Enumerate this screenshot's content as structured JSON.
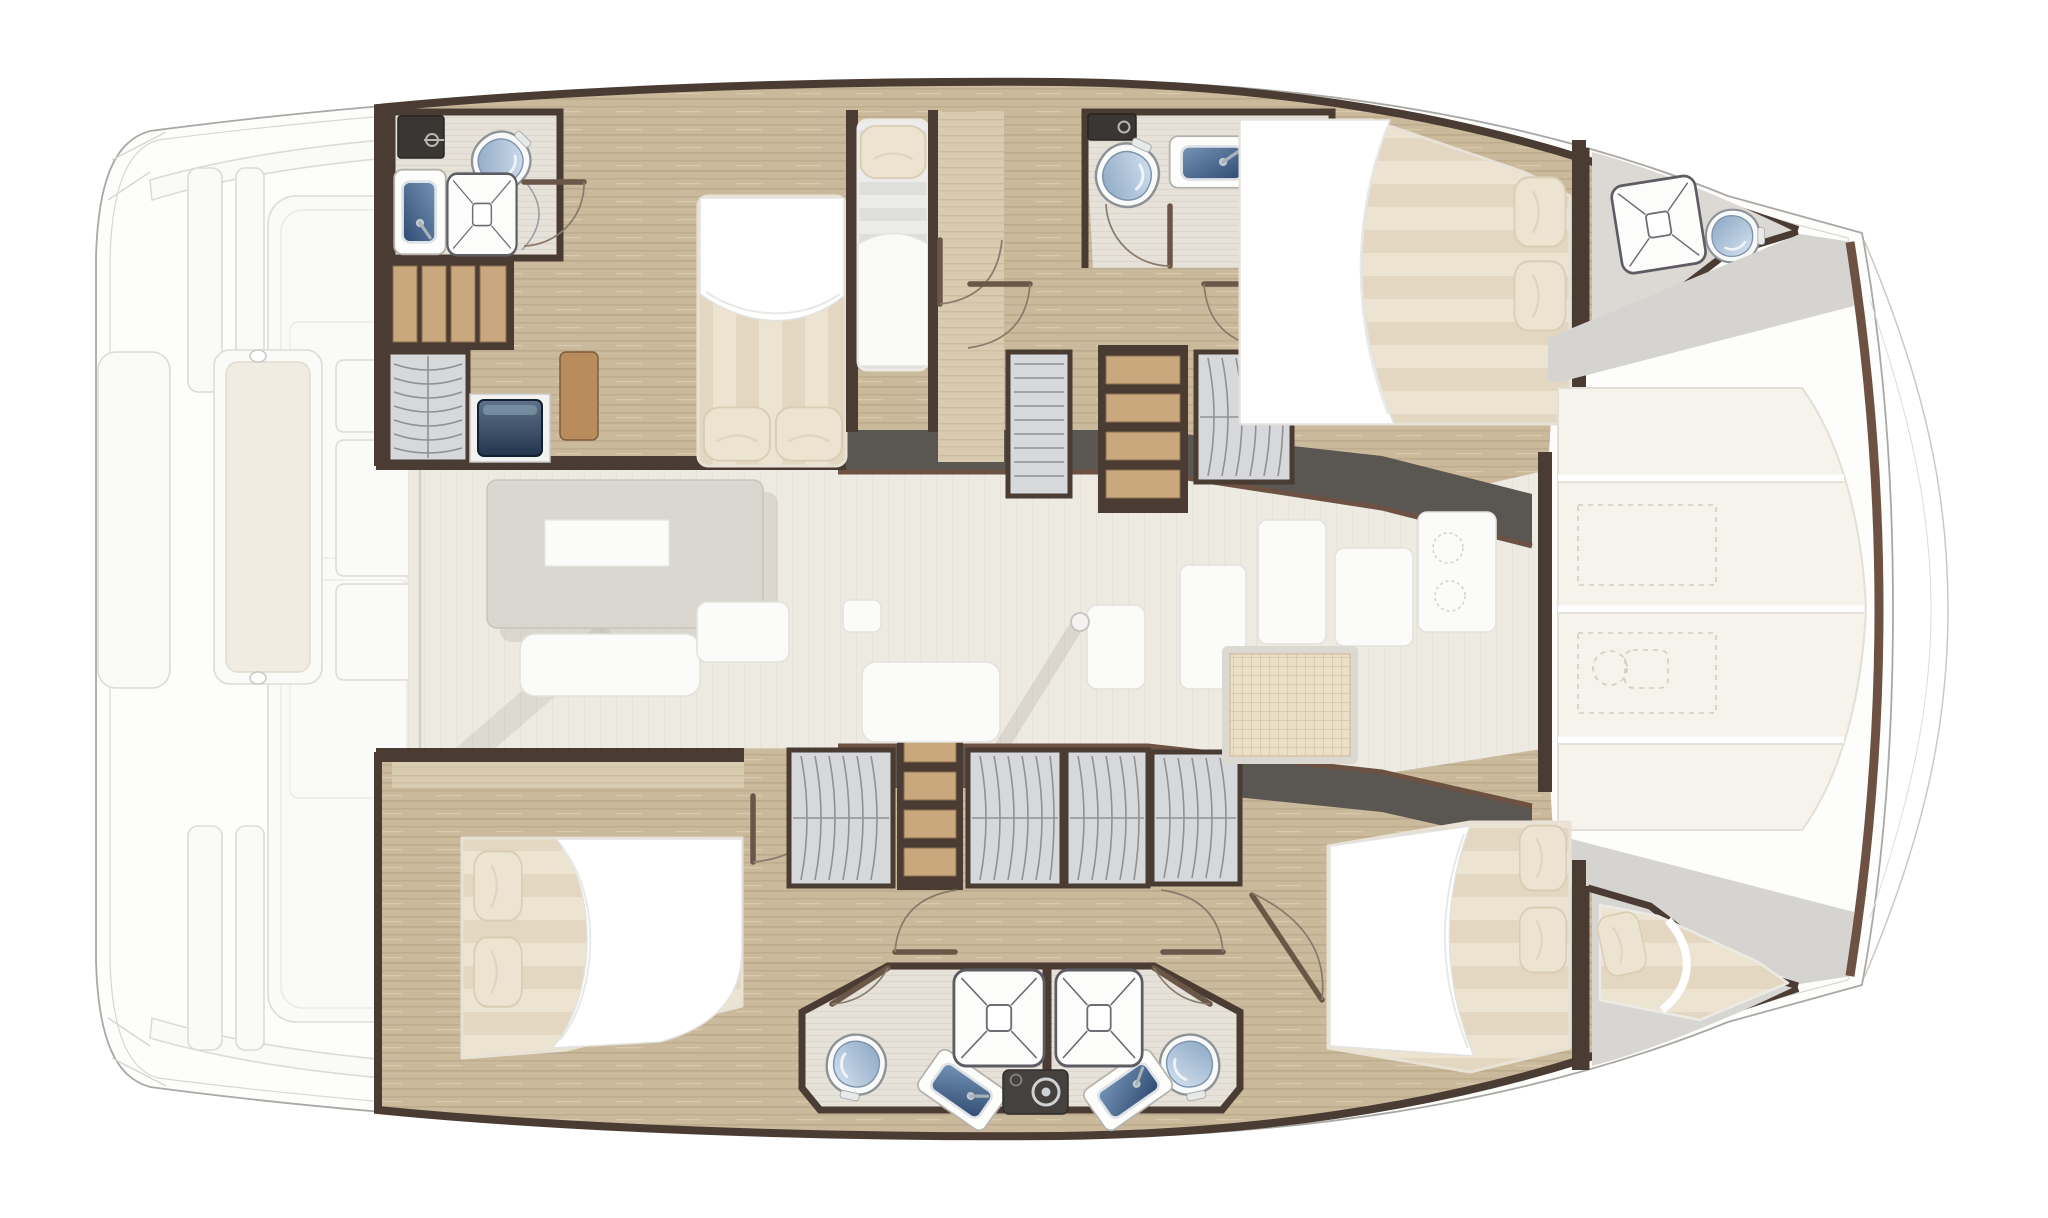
{
  "diagram": {
    "subject": "catamaran-interior-floor-plan",
    "orientation": {
      "bow": "right",
      "stern": "left"
    },
    "rooms": [
      {
        "id": "salon",
        "label": "salon-bridgedeck"
      },
      {
        "id": "aft-cockpit",
        "label": "aft-cockpit-and-platform"
      },
      {
        "id": "port-aft-head",
        "label": "port-aft-head"
      },
      {
        "id": "port-aft-berth",
        "label": "port-aft-berth"
      },
      {
        "id": "port-single-berth",
        "label": "port-single-berth"
      },
      {
        "id": "port-mid-head",
        "label": "port-mid-head"
      },
      {
        "id": "port-forward-cabin",
        "label": "port-forward-cabin"
      },
      {
        "id": "port-bow-head",
        "label": "port-bow-head"
      },
      {
        "id": "stbd-aft-cabin",
        "label": "starboard-aft-cabin"
      },
      {
        "id": "stbd-left-head",
        "label": "starboard-aft-shower-head"
      },
      {
        "id": "stbd-right-head",
        "label": "starboard-forward-shower-head"
      },
      {
        "id": "stbd-forward-cabin",
        "label": "starboard-forward-cabin"
      },
      {
        "id": "forepeak-berth",
        "label": "forepeak-berth"
      },
      {
        "id": "foredeck-lounge",
        "label": "foredeck-lounge-cushions"
      }
    ],
    "fixtures": {
      "toilets": 5,
      "bathroom_sinks": 4,
      "showers": 5,
      "washing_machines": 1,
      "beds": 6,
      "stair_flights": 2,
      "wardrobes": 8,
      "dining_table": 1,
      "mast_post": 1
    }
  },
  "palette": {
    "wall": "#4a3b33",
    "band": "#5a5652",
    "trim": "#6d5243",
    "wood_base": "#cbb99c",
    "wood_grain": "#b5a183",
    "wood_light": "#d8cbb0",
    "matt_a": "#ece3d1",
    "matt_b": "#ddcfb6",
    "gray_a": "#ececeb",
    "gray_b": "#dededd",
    "pillow": "#ece4d0",
    "cushion": "#f6f3ec",
    "salon_floor": "#edeae2",
    "head_floor": "#e6e1d9",
    "locker_fill": "#d7d8db",
    "locker_line": "#8f9194",
    "navy": "#32465e",
    "washer": "#45413e",
    "grid_bg": "#ecdfc8",
    "grid_line": "#cdb894",
    "deck_fill": "#fafaf9",
    "deck_stroke": "#dcdbd7",
    "outline": "#a9a8a5",
    "door": "#6b5748",
    "door_arc": "#8a7a6b",
    "tread": "#c9a87e",
    "dash": "#cfccc2",
    "bench_cushion": "#f0ece1"
  }
}
